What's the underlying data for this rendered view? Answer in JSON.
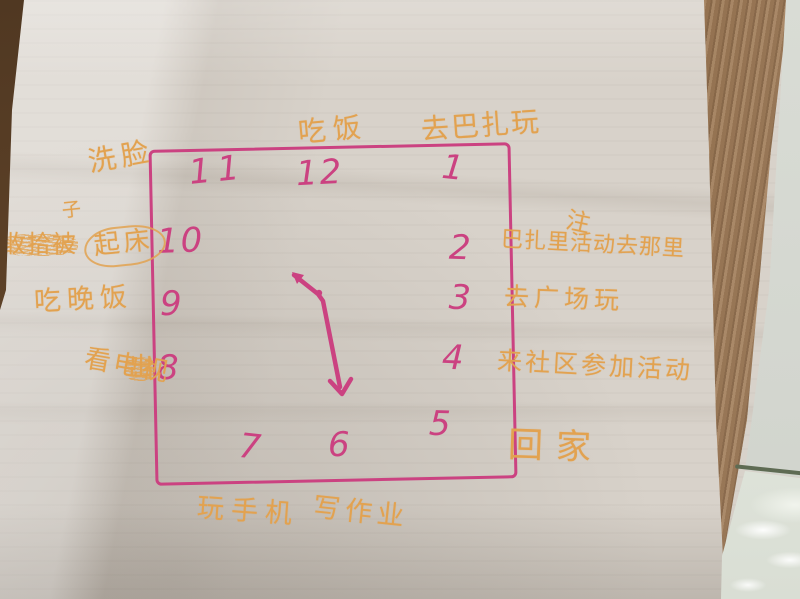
{
  "photo": {
    "description": "Photo of a child's hand-drawn daily-schedule clock: a square clock face drawn in pink marker on crumpled tissue-like paper, annotated in orange marker with daily activities in Chinese, lying on a wooden table with glossy tile floor visible at the right edge.",
    "background": {
      "table": "wood grain strip along right edge and top-left corner",
      "floor": "glossy white tile, bottom right"
    }
  },
  "colors": {
    "ink_pink": "#cb4281",
    "ink_orange": "#e2a250",
    "paper": "#d8d2ca",
    "wood": "#9b7a58",
    "wood_dark": "#5d4127",
    "tile": "#dfe3da"
  },
  "clock": {
    "shape": "hand-drawn square",
    "numbers": [
      {
        "label": "11"
      },
      {
        "label": "12"
      },
      {
        "label": "1"
      },
      {
        "label": "10"
      },
      {
        "label": "2"
      },
      {
        "label": "9"
      },
      {
        "label": "3"
      },
      {
        "label": "8"
      },
      {
        "label": "4"
      },
      {
        "label": "7"
      },
      {
        "label": "6"
      },
      {
        "label": "5"
      }
    ],
    "hands": {
      "short_hand_points_toward": "between 10 and 11",
      "long_hand_points_toward": "6"
    }
  },
  "annotations": {
    "top_eat": "吃饭",
    "top_bazaar": "去巴扎玩",
    "left_wash_face": "洗脸",
    "left_superscript": "子",
    "left_scribble_1": "收拾被",
    "left_get_up": "起床",
    "left_dinner": "吃晚饭",
    "left_scribble_2": "出",
    "left_watch_tv": "看电视",
    "bottom_play_phone": "玩手机",
    "bottom_homework": "写作业",
    "right_note_title": "注",
    "right_note_line1": "巴扎里活动去那里",
    "right_note_line2": "去广场玩",
    "right_note_line3": "来社区参加活动",
    "right_go_home": "回家"
  }
}
